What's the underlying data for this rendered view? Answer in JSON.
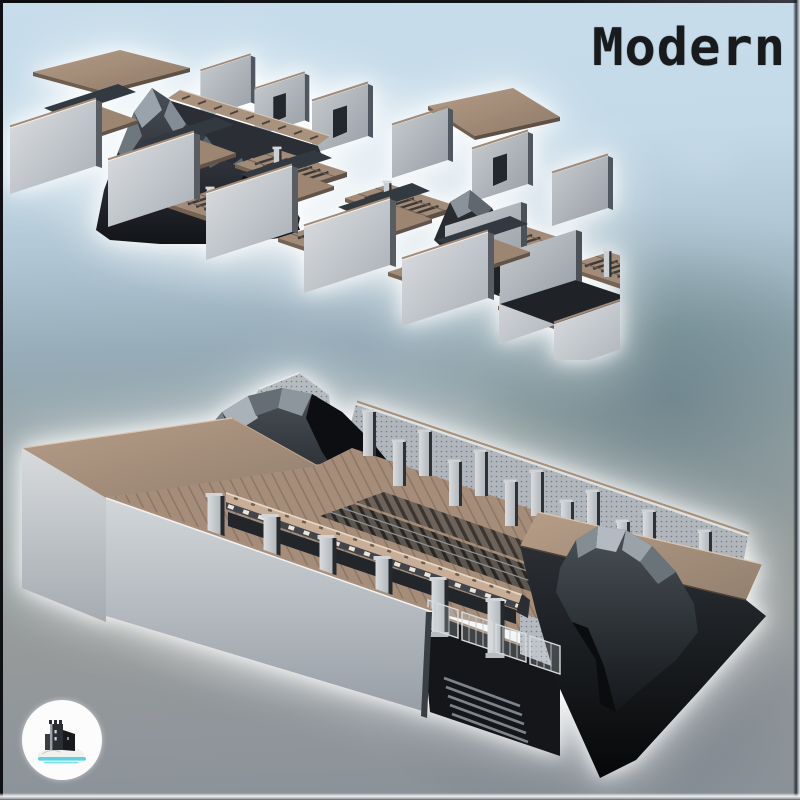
{
  "artwork": {
    "title": "Modern",
    "scenes": {
      "exploded": {
        "alt": "exploded view of modular metro station terrain tiles"
      },
      "assembled": {
        "alt": "assembled modern metro station with tracks, train, rocks and stairs"
      }
    }
  },
  "logo": {
    "icon": "castle-on-hill-logo",
    "circle_color": "#fcfcfc",
    "water_color": "#5bd2e0",
    "castle_color": "#25282d"
  },
  "palette": {
    "sky_blue": "#c7ddeb",
    "steel_blue": "#8299a7",
    "ground_gray": "#8f959b",
    "roof_tan": "#a78f7b",
    "wall_gray": "#c6cacd",
    "rock_dark": "#1d2126",
    "glow_white": "#ffffff",
    "title_color": "#181a1c"
  }
}
